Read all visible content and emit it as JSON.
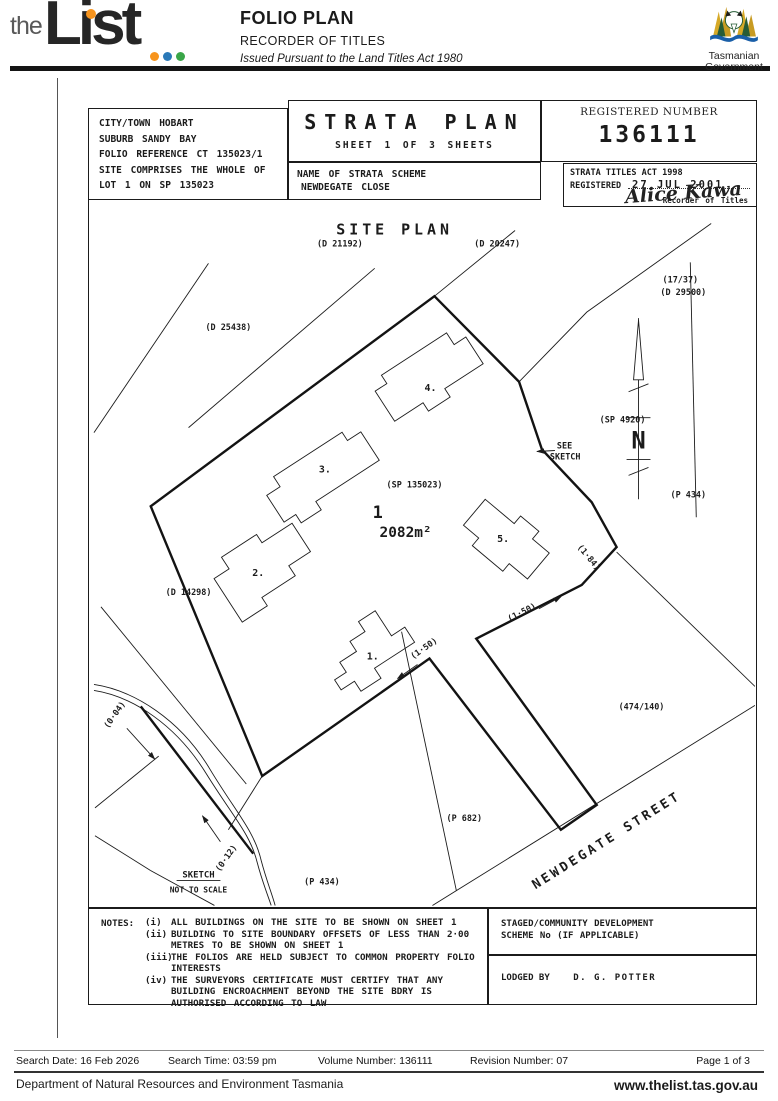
{
  "header": {
    "logo_the": "the",
    "logo_list": "List",
    "title": "FOLIO PLAN",
    "subtitle": "RECORDER OF TITLES",
    "tagline": "Issued Pursuant to the Land Titles Act 1980",
    "gov_line1": "Tasmanian",
    "gov_line2": "Government",
    "accent_orange": "#f7941d",
    "accent_blue": "#2a79b8",
    "accent_green": "#3aa648"
  },
  "plan": {
    "location_lines": [
      "CITY/TOWN HOBART",
      "SUBURB SANDY BAY",
      "FOLIO REFERENCE CT 135023/1",
      "SITE COMPRISES THE WHOLE OF",
      "LOT 1 ON SP 135023"
    ],
    "title": "STRATA PLAN",
    "sheet": "SHEET 1 OF 3 SHEETS",
    "registered_number_label": "REGISTERED NUMBER",
    "registered_number": "136111",
    "scheme_label": "NAME OF STRATA SCHEME",
    "scheme_name": "NEWDEGATE CLOSE",
    "act_line": "STRATA TITLES ACT 1998",
    "registered_label": "REGISTERED",
    "registered_date": "27 JUL 2001",
    "signature": "Alice Kawa",
    "signature_title": "Recorder of Titles",
    "mapsheet_line1": "MAPSHEET MUNICIPAL",
    "mapsheet_line2": "CODE No 114/5225-42",
    "last_upi_label": "LAST UPI No",
    "last_upi_value": "GJV56",
    "scale": "SCALE 1:300",
    "lengths": "LENGTHS IN METRES"
  },
  "drawing": {
    "site_plan_title": "SITE PLAN",
    "parcels": {
      "d21192": "(D 21192)",
      "d20247": "(D 20247)",
      "d25438": "(D 25438)",
      "t1737": "(17/37)",
      "d29500": "(D 29500)",
      "sp4920": "(SP 4920)",
      "p434_right": "(P 434)",
      "sp135023": "(SP 135023)",
      "d14298": "(D 14298)",
      "t474140": "(474/140)",
      "p682": "(P 682)",
      "p434_sketch": "(P 434)"
    },
    "lot_number": "1",
    "lot_area": "2082m²",
    "buildings": [
      "1.",
      "2.",
      "3.",
      "4.",
      "5."
    ],
    "dims": {
      "d150a": "(1·50)",
      "d150b": "(1·50)",
      "d184": "(1·84)",
      "d004": "(0·04)",
      "d012": "(0·12)"
    },
    "street": "NEWDEGATE  STREET",
    "see_sketch_line1": "SEE",
    "see_sketch_line2": "SKETCH",
    "sketch_title": "SKETCH",
    "sketch_sub": "NOT TO SCALE",
    "north_letter": "N"
  },
  "notes": {
    "label": "NOTES:",
    "items": [
      {
        "num": "(i)",
        "text": "ALL BUILDINGS ON THE SITE TO BE SHOWN ON SHEET 1"
      },
      {
        "num": "(ii)",
        "text": "BUILDING TO SITE BOUNDARY OFFSETS OF LESS THAN 2·00 METRES TO BE SHOWN ON SHEET 1"
      },
      {
        "num": "(iii)",
        "text": "THE FOLIOS ARE HELD SUBJECT TO COMMON PROPERTY FOLIO INTERESTS"
      },
      {
        "num": "(iv)",
        "text": "THE SURVEYORS CERTIFICATE MUST CERTIFY THAT ANY BUILDING ENCROACHMENT BEYOND THE SITE BDRY IS AUTHORISED ACCORDING TO LAW"
      }
    ]
  },
  "staged": {
    "line1": "STAGED/COMMUNITY DEVELOPMENT",
    "line2": "SCHEME No (IF APPLICABLE)"
  },
  "lodged": {
    "label": "LODGED BY",
    "value": "D. G. POTTER"
  },
  "footer": {
    "search_date": "Search Date: 16 Feb 2026",
    "search_time": "Search Time: 03:59 pm",
    "volume": "Volume Number: 136111",
    "revision": "Revision Number: 07",
    "page": "Page 1 of 3",
    "department": "Department of Natural Resources and Environment Tasmania",
    "website": "www.thelist.tas.gov.au"
  }
}
